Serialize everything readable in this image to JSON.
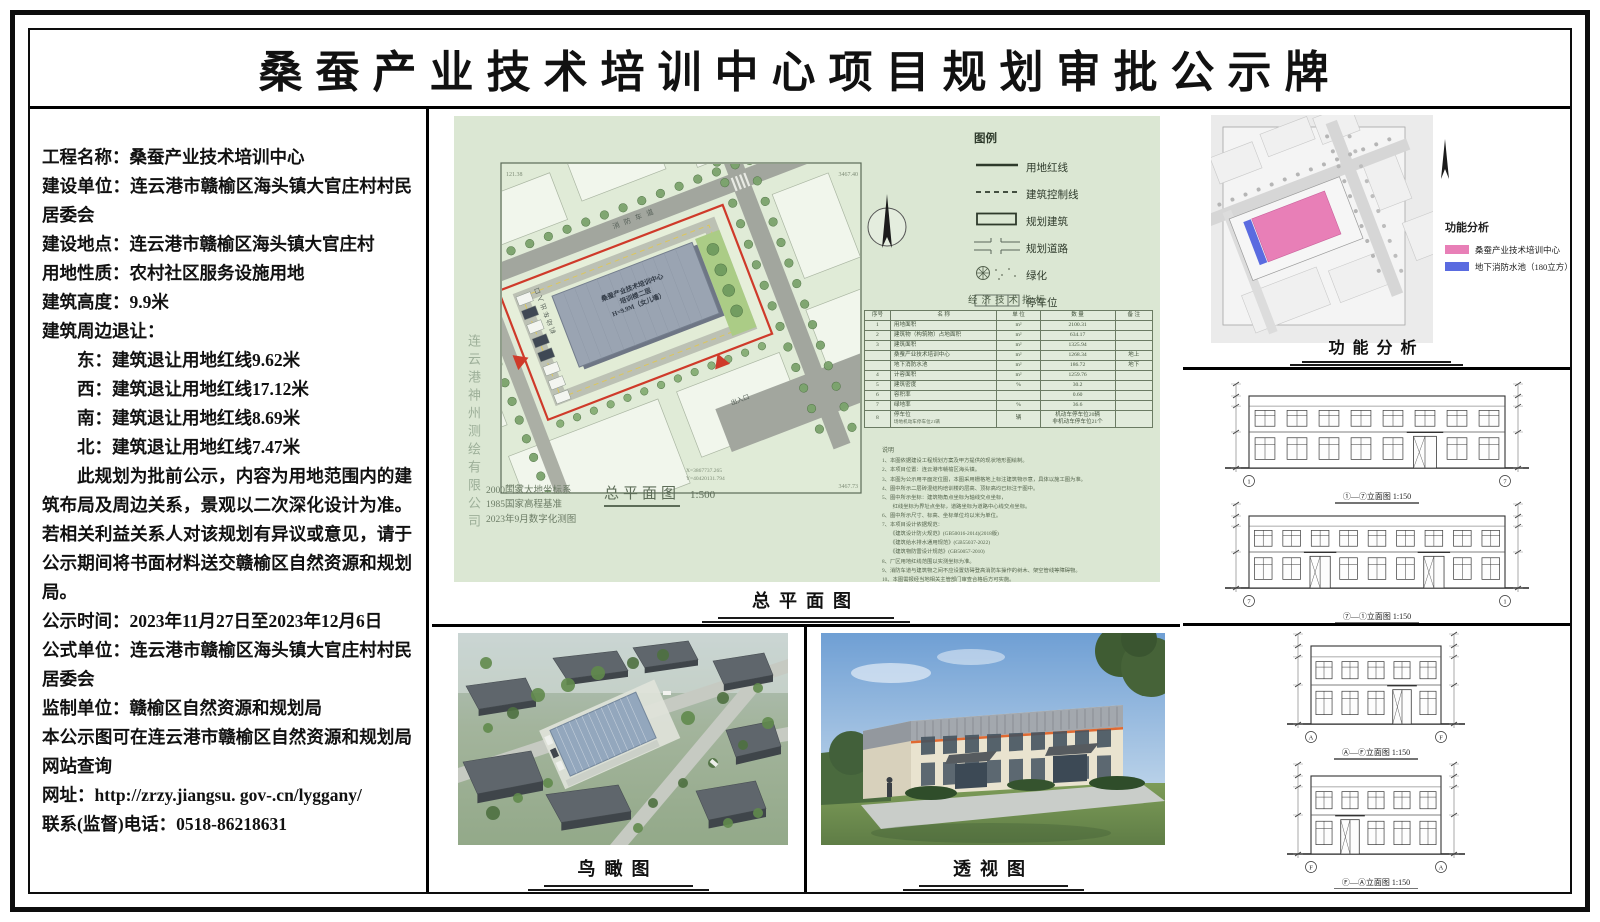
{
  "title": "桑蚕产业技术培训中心项目规划审批公示牌",
  "colors": {
    "boundary_red": "#cf3a2a",
    "sheet_green": "#dbe7d3",
    "function_pink": "#e87fb7",
    "function_blue": "#5a6be0"
  },
  "info": {
    "paragraphs": [
      {
        "text": "工程名称：桑蚕产业技术培训中心"
      },
      {
        "text": "建设单位：连云港市赣榆区海头镇大官庄村村民居委会"
      },
      {
        "text": "建设地点：连云港市赣榆区海头镇大官庄村"
      },
      {
        "text": "用地性质：农村社区服务设施用地"
      },
      {
        "text": "建筑高度：9.9米"
      },
      {
        "text": "建筑周边退让："
      },
      {
        "text": "东：建筑退让用地红线9.62米",
        "indent": 1
      },
      {
        "text": "西：建筑退让用地红线17.12米",
        "indent": 1
      },
      {
        "text": "南：建筑退让用地红线8.69米",
        "indent": 1
      },
      {
        "text": "北：建筑退让用地红线7.47米",
        "indent": 1
      },
      {
        "text": "此规划为批前公示，内容为用地范围内的建筑布局及周边关系，景观以二次深化设计为准。若相关利益关系人对该规划有异议或意见，请于公示期间将书面材料送交赣榆区自然资源和规划局。",
        "first": 1
      },
      {
        "text": "公示时间：2023年11月27日至2023年12月6日"
      },
      {
        "text": "公式单位：连云港市赣榆区海头镇大官庄村村民居委会"
      },
      {
        "text": "监制单位：赣榆区自然资源和规划局"
      },
      {
        "text": "本公示图可在连云港市赣榆区自然资源和规划局网站查询"
      },
      {
        "text": "网址：http://zrzy.jiangsu. gov-.cn/lyggany/"
      },
      {
        "text": "联系(监督)电话：0518-86218631"
      }
    ]
  },
  "site_plan": {
    "caption": "总平面图",
    "scale_caption": "总平面图",
    "scale_value": "1:500",
    "datum_lines": [
      "2000国家大地坐标系",
      "1985国家高程基准",
      "2023年9月数字化测图"
    ],
    "watermark": "连云港神州测绘有限公司",
    "building_label": [
      "桑蚕产业技术培训中心",
      "培训楼二层",
      "H=9.9M（女儿墙）"
    ],
    "road_label": "消防车道",
    "entrance_label": "机动车出入口",
    "exit_label": "出入口",
    "corner_labels": [
      "121.38",
      "3467.40",
      "3467.73",
      "101.58"
    ],
    "coord_labels": [
      "X=3867737.265",
      "Y=40420131.794"
    ],
    "legend": {
      "header": "图例",
      "items": [
        {
          "symbol": "solid-line",
          "label": "用地红线"
        },
        {
          "symbol": "dashed-line",
          "label": "建筑控制线"
        },
        {
          "symbol": "rect",
          "label": "规划建筑"
        },
        {
          "symbol": "road",
          "label": "规划道路"
        },
        {
          "symbol": "green",
          "label": "绿化"
        },
        {
          "symbol": "parking",
          "label": "停车位"
        }
      ]
    },
    "indicators": {
      "title": "经济技术指标",
      "columns": [
        "序号",
        "名  称",
        "单  位",
        "数  量",
        "备  注"
      ],
      "rows": [
        {
          "no": "1",
          "name": "用地面积",
          "unit": "m²",
          "qty": "2100.31",
          "note": ""
        },
        {
          "no": "2",
          "name": "建筑物（构筑物）占地面积",
          "unit": "m²",
          "qty": "634.17",
          "note": ""
        },
        {
          "no": "3",
          "name": "建筑面积",
          "unit": "m²",
          "qty": "1325.94",
          "note": ""
        },
        {
          "no": "",
          "name": "桑蚕产业技术培训中心",
          "unit": "m²",
          "qty": "1268.34",
          "note": "地上"
        },
        {
          "no": "",
          "name": "地下消防水池",
          "unit": "m²",
          "qty": "186.72",
          "note": "地下"
        },
        {
          "no": "4",
          "name": "计容面积",
          "unit": "m²",
          "qty": "1259.76",
          "note": ""
        },
        {
          "no": "5",
          "name": "建筑密度",
          "unit": "%",
          "qty": "30.2",
          "note": ""
        },
        {
          "no": "6",
          "name": "容积率",
          "unit": "",
          "qty": "0.60",
          "note": ""
        },
        {
          "no": "7",
          "name": "绿地率",
          "unit": "%",
          "qty": "36.6",
          "note": ""
        },
        {
          "no": "8",
          "name": "停车位",
          "sub": "场地机动车停车位21辆",
          "unit": "辆",
          "qty": [
            "机动车停车位20辆",
            "非机动车停车位21个"
          ],
          "note": ""
        }
      ]
    },
    "notes": {
      "header": "说明",
      "lines": [
        "1、本图依据建设工程规划方案及甲方提供的现状地形图绘制。",
        "2、本项目位置：连云港市赣榆区海头镇。",
        "3、本图为公示用平面定位图，本图采用栅格地上标注建筑物示意，具体以施工图为准。",
        "4、图中所示二层砖混结构培训楼的层高、顶标高均已标注于图中。",
        "5、图中所示坐标：建筑物角点坐标为轴线交点坐标，",
        "　　红线坐标为界址点坐标，道路坐标为道路中心线交点坐标。",
        "6、图中所示尺寸、标高、坐标单位均以米为单位。",
        "7、本项目设计依据规范：",
        "　　《建筑设计防火规范》(GB50016-2014)(2018版)",
        "　　《建筑给水排水通用规范》(GB55037-2022)",
        "　　《建筑物防雷设计规范》(GB50057-2010)",
        "8、厂区用地红线范围以实测坐标为准。",
        "9、消防车道与建筑物之间不应设置妨碍登高消防车操作的树木、架空管线等障碍物。",
        "10、本图需报经当地相关主管部门审查合格后方可实施。"
      ]
    }
  },
  "function_analysis": {
    "caption": "功能分析",
    "legend_header": "功能分析",
    "items": [
      {
        "label": "桑蚕产业技术培训中心",
        "color": "#e87fb7"
      },
      {
        "label": "地下消防水池（180立方）",
        "color": "#5a6be0"
      }
    ]
  },
  "birdseye": {
    "caption": "鸟瞰图"
  },
  "perspective": {
    "caption": "透视图"
  },
  "elevations": {
    "captions": [
      "①—⑦立面图 1:150",
      "⑦—①立面图 1:150",
      "Ⓐ—Ⓕ立面图 1:150",
      "Ⓕ—Ⓐ立面图 1:150"
    ]
  }
}
